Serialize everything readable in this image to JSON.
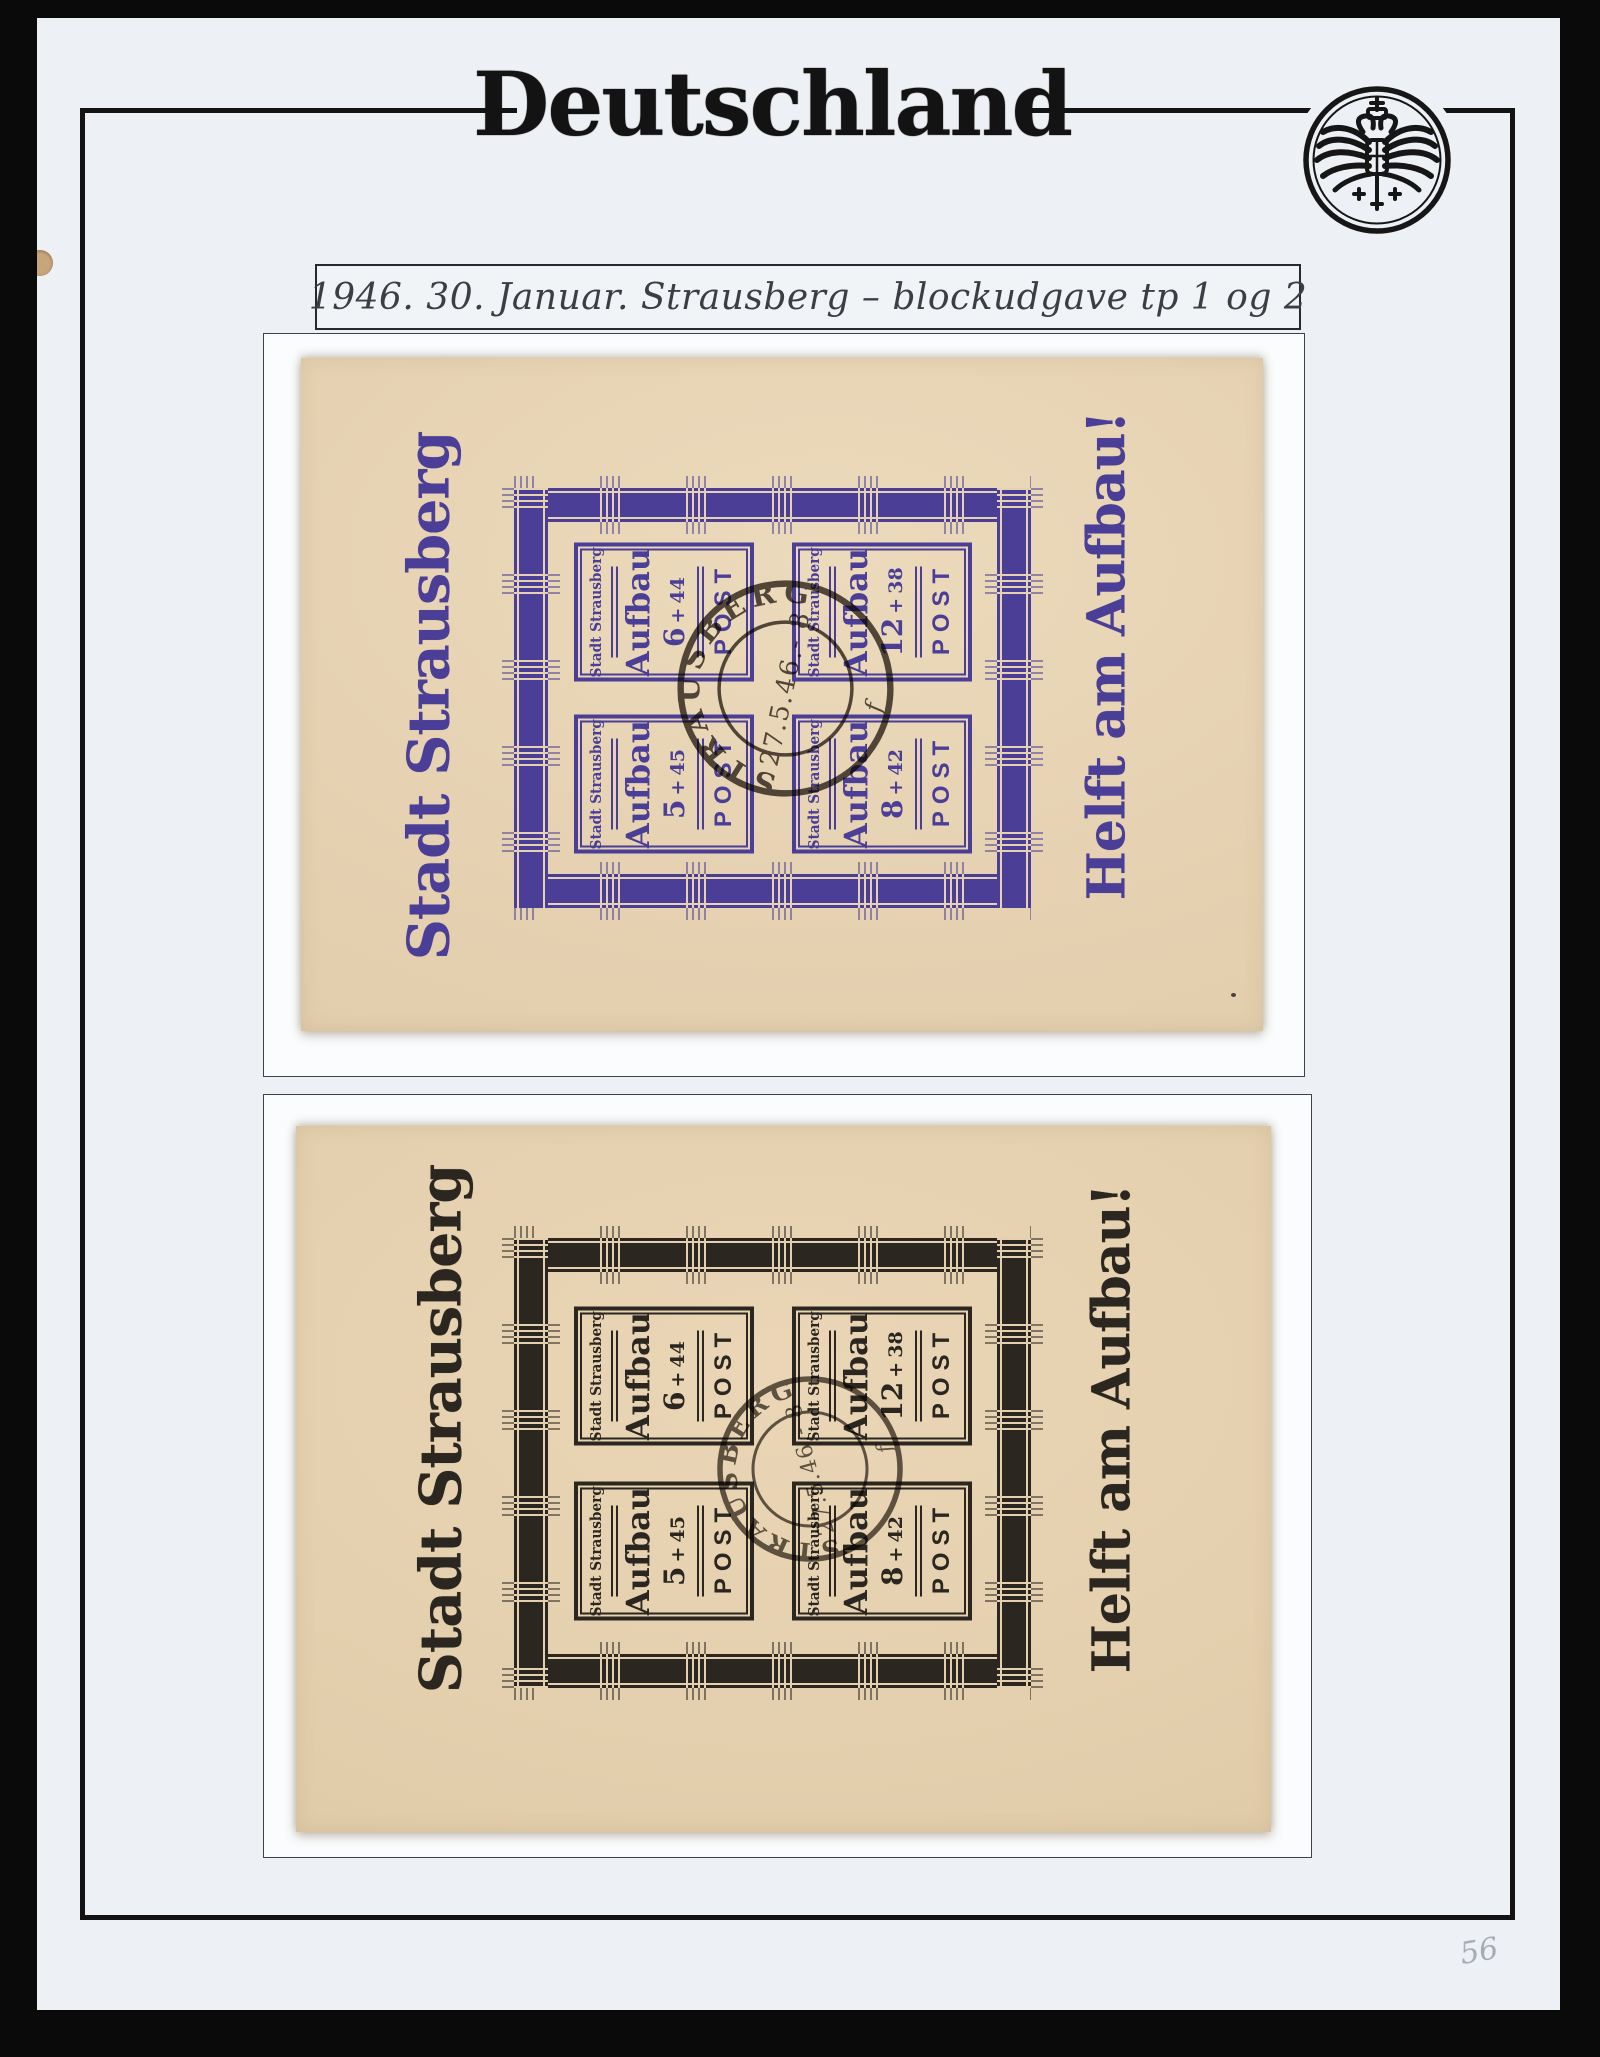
{
  "page": {
    "title": "Deutschland",
    "caption": "1946. 30. Januar. Strausberg – blockudgave tp 1 og 2",
    "pencil_note": "56",
    "seal_icon": "imperial-eagle-seal"
  },
  "colors": {
    "page_background": "#edf0f4",
    "scan_background": "#0a0a0a",
    "frame_black": "#131313",
    "cream_paper_top_block": "#e6d2b2",
    "cream_paper_bottom_block": "#e4d0ae",
    "violet_ink": "#4b3e96",
    "black_ink": "#2b2620",
    "postmark_ink": "#39322b",
    "pencil_gray": "#a7acb4"
  },
  "blocks": [
    {
      "ink_color": "violet",
      "left_text": "Stadt Strausberg",
      "right_text": "Helft am Aufbau!",
      "stamps": [
        {
          "header": "Stadt Strausberg",
          "word": "Aufbau",
          "value_main": "6",
          "value_plus": "+",
          "value_addon": "44",
          "post": "POST"
        },
        {
          "header": "Stadt Strausberg",
          "word": "Aufbau",
          "value_main": "12",
          "value_plus": "+",
          "value_addon": "38",
          "post": "POST"
        },
        {
          "header": "Stadt Strausberg",
          "word": "Aufbau",
          "value_main": "5",
          "value_plus": "+",
          "value_addon": "45",
          "post": "POST"
        },
        {
          "header": "Stadt Strausberg",
          "word": "Aufbau",
          "value_main": "8",
          "value_plus": "+",
          "value_addon": "42",
          "post": "POST"
        }
      ],
      "postmark": {
        "town": "STRAUSBERG",
        "date": "27.5.46.- 8",
        "letter": "f"
      }
    },
    {
      "ink_color": "black",
      "left_text": "Stadt Strausberg",
      "right_text": "Helft am Aufbau!",
      "stamps": [
        {
          "header": "Stadt Strausberg",
          "word": "Aufbau",
          "value_main": "6",
          "value_plus": "+",
          "value_addon": "44",
          "post": "POST"
        },
        {
          "header": "Stadt Strausberg",
          "word": "Aufbau",
          "value_main": "12",
          "value_plus": "+",
          "value_addon": "38",
          "post": "POST"
        },
        {
          "header": "Stadt Strausberg",
          "word": "Aufbau",
          "value_main": "5",
          "value_plus": "+",
          "value_addon": "45",
          "post": "POST"
        },
        {
          "header": "Stadt Strausberg",
          "word": "Aufbau",
          "value_main": "8",
          "value_plus": "+",
          "value_addon": "42",
          "post": "POST"
        }
      ],
      "postmark": {
        "town": "STRAUSBERG",
        "date": "27.5.46.- 8",
        "letter": "f"
      }
    }
  ]
}
